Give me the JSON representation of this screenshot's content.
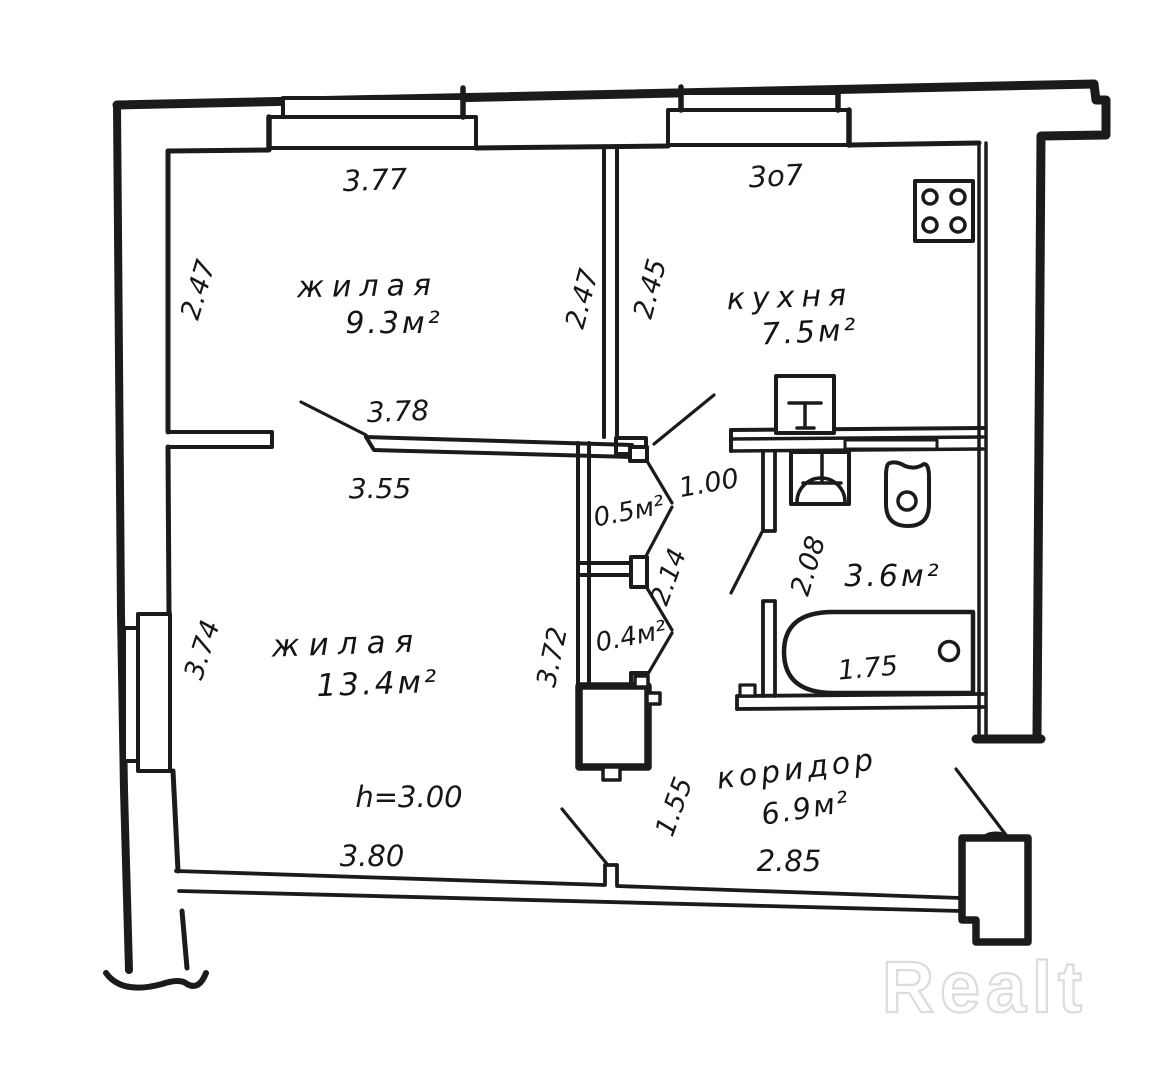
{
  "document_type": "hand-drawn apartment floor plan",
  "watermark": "Realt",
  "rooms": {
    "living1": {
      "name": "жилая",
      "area": "9.3м²"
    },
    "kitchen": {
      "name": "кухня",
      "area": "7.5м²"
    },
    "living2": {
      "name": "жилая",
      "area": "13.4м²"
    },
    "corridor": {
      "name": "коридор",
      "area": "6.9м²"
    },
    "bathroom": {
      "area": "3.6м²"
    },
    "closet_top": {
      "area": "0.5м²"
    },
    "closet_bottom": {
      "area": "0.4м²"
    }
  },
  "dims": {
    "top_living": "3.77",
    "top_kitchen": "3o7",
    "living1_left": "2.47",
    "living1_right": "2.47",
    "kitchen_left": "2.45",
    "wall_under_living1": "3.78",
    "living2_top": "3.55",
    "closet_door": "1.00",
    "closet_column": "2.14",
    "bathroom_width": "2.08",
    "bathtub_length": "1.75",
    "living2_left": "3.74",
    "living2_right": "3.72",
    "living2_bottom": "3.80",
    "corridor_opening": "1.55",
    "corridor_bottom": "2.85",
    "ceiling_height": "h=3.00"
  },
  "fixtures": [
    "stove",
    "kitchen-sink",
    "washbasin",
    "toilet",
    "bathtub",
    "vent-shaft",
    "entry-door-block",
    "window"
  ]
}
